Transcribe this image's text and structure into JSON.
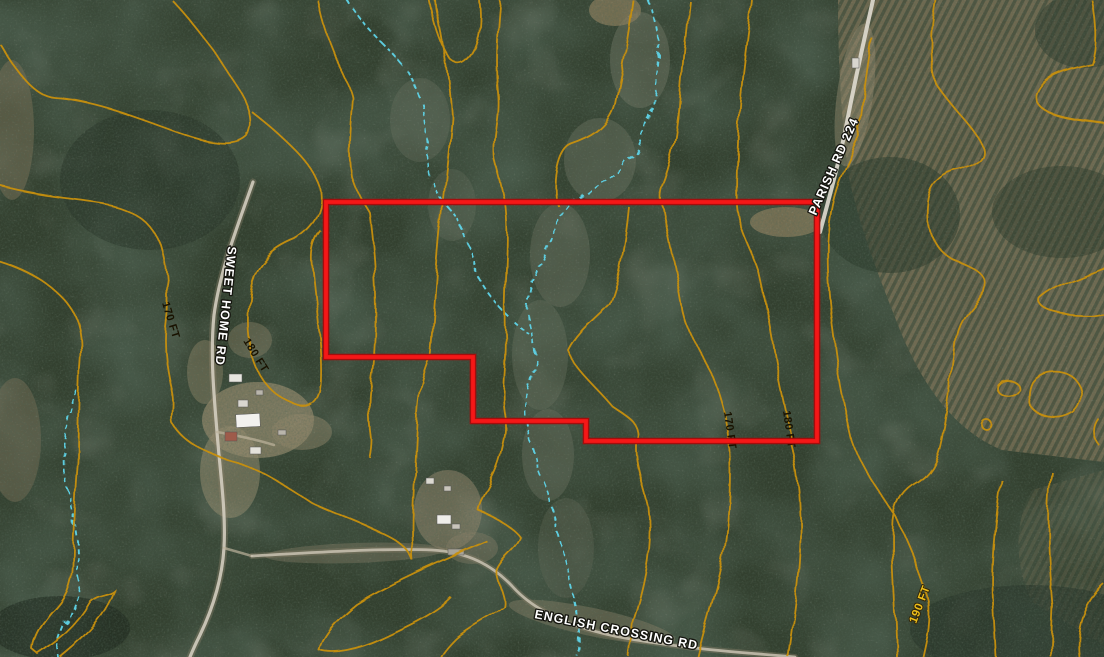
{
  "map": {
    "description": "Aerial topographic map with parcel boundary",
    "parcel_boundary": {
      "color": "#f21414"
    },
    "road_labels": [
      {
        "name": "SWEET HOME RD"
      },
      {
        "name": "PARISH RD 224"
      },
      {
        "name": "ENGLISH CROSSING RD"
      }
    ],
    "contour_labels": [
      {
        "text": "170 FT"
      },
      {
        "text": "180 FT"
      },
      {
        "text": "170 FT"
      },
      {
        "text": "180 FT"
      },
      {
        "text": "190 FT"
      }
    ],
    "colors": {
      "contour": "#c8900f",
      "contour_bright": "#e8b61a",
      "stream": "#5fd4e8",
      "boundary_red": "#f21414",
      "road": "#d8d2c4"
    }
  }
}
